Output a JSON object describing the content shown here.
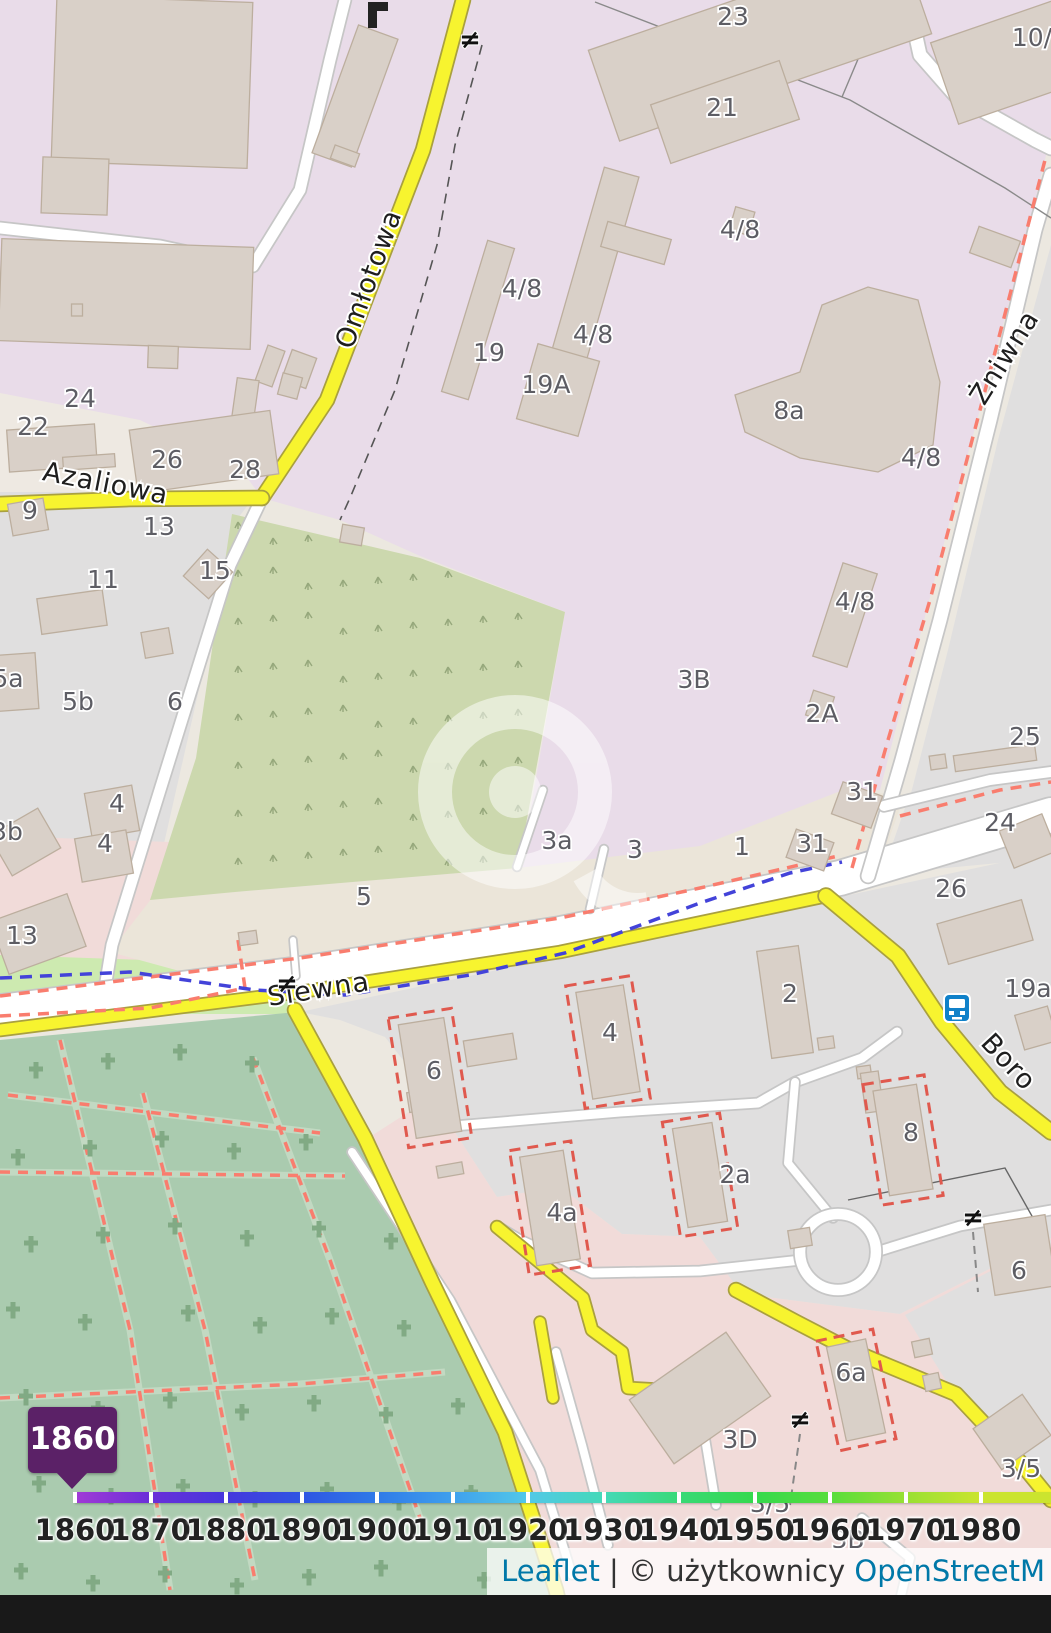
{
  "map": {
    "streets": [
      {
        "name": "Omłotowa",
        "x": 377,
        "y": 282,
        "rot": -70
      },
      {
        "name": "Azaliowa",
        "x": 104,
        "y": 492,
        "rot": 11
      },
      {
        "name": "Siewna",
        "x": 320,
        "y": 998,
        "rot": -9
      },
      {
        "name": "Żniwna",
        "x": 1012,
        "y": 362,
        "rot": -58
      },
      {
        "name": "Boro",
        "x": 1002,
        "y": 1068,
        "rot": 47
      }
    ],
    "house_numbers": [
      {
        "t": "23",
        "x": 733,
        "y": 25
      },
      {
        "t": "21",
        "x": 722,
        "y": 116
      },
      {
        "t": "10/",
        "x": 1032,
        "y": 46
      },
      {
        "t": "4/8",
        "x": 522,
        "y": 297
      },
      {
        "t": "4/8",
        "x": 593,
        "y": 343
      },
      {
        "t": "4/8",
        "x": 740,
        "y": 238
      },
      {
        "t": "4/8",
        "x": 921,
        "y": 466
      },
      {
        "t": "4/8",
        "x": 855,
        "y": 610
      },
      {
        "t": "19",
        "x": 489,
        "y": 361
      },
      {
        "t": "19A",
        "x": 546,
        "y": 393
      },
      {
        "t": "8a",
        "x": 789,
        "y": 419
      },
      {
        "t": "3B",
        "x": 694,
        "y": 688
      },
      {
        "t": "2A",
        "x": 822,
        "y": 722
      },
      {
        "t": "31",
        "x": 862,
        "y": 800
      },
      {
        "t": "31",
        "x": 812,
        "y": 852
      },
      {
        "t": "1",
        "x": 742,
        "y": 855
      },
      {
        "t": "3",
        "x": 635,
        "y": 858
      },
      {
        "t": "3a",
        "x": 557,
        "y": 849
      },
      {
        "t": "5",
        "x": 364,
        "y": 905
      },
      {
        "t": "24",
        "x": 80,
        "y": 407
      },
      {
        "t": "22",
        "x": 33,
        "y": 435
      },
      {
        "t": "26",
        "x": 167,
        "y": 468
      },
      {
        "t": "28",
        "x": 245,
        "y": 478
      },
      {
        "t": "9",
        "x": 30,
        "y": 519
      },
      {
        "t": "13",
        "x": 159,
        "y": 535
      },
      {
        "t": "15",
        "x": 215,
        "y": 579
      },
      {
        "t": "11",
        "x": 103,
        "y": 588
      },
      {
        "t": "5a",
        "x": 8,
        "y": 687
      },
      {
        "t": "5b",
        "x": 78,
        "y": 710
      },
      {
        "t": "6",
        "x": 175,
        "y": 710
      },
      {
        "t": "4",
        "x": 117,
        "y": 812
      },
      {
        "t": "4",
        "x": 105,
        "y": 852
      },
      {
        "t": "3b",
        "x": 7,
        "y": 840
      },
      {
        "t": "13",
        "x": 22,
        "y": 944
      },
      {
        "t": "25",
        "x": 1025,
        "y": 745
      },
      {
        "t": "24",
        "x": 1000,
        "y": 831
      },
      {
        "t": "26",
        "x": 951,
        "y": 897
      },
      {
        "t": "19a",
        "x": 1028,
        "y": 997
      },
      {
        "t": "2",
        "x": 790,
        "y": 1002
      },
      {
        "t": "6",
        "x": 434,
        "y": 1079
      },
      {
        "t": "4",
        "x": 610,
        "y": 1041
      },
      {
        "t": "4a",
        "x": 562,
        "y": 1221
      },
      {
        "t": "2a",
        "x": 735,
        "y": 1183
      },
      {
        "t": "8",
        "x": 911,
        "y": 1141
      },
      {
        "t": "6",
        "x": 1019,
        "y": 1279
      },
      {
        "t": "6a",
        "x": 851,
        "y": 1381
      },
      {
        "t": "3D",
        "x": 740,
        "y": 1448
      },
      {
        "t": "3/5",
        "x": 770,
        "y": 1512
      },
      {
        "t": "3/5",
        "x": 1021,
        "y": 1477
      },
      {
        "t": "3B",
        "x": 848,
        "y": 1548
      }
    ],
    "gate_symbol": "≠",
    "gates": [
      {
        "x": 470,
        "y": 48
      },
      {
        "x": 287,
        "y": 992
      },
      {
        "x": 973,
        "y": 1226
      },
      {
        "x": 800,
        "y": 1428
      }
    ],
    "bus_stop": {
      "x": 957,
      "y": 1008
    }
  },
  "timeline": {
    "years": [
      "1860",
      "1870",
      "1880",
      "1890",
      "1900",
      "1910",
      "1920",
      "1930",
      "1940",
      "1950",
      "1960",
      "1970",
      "1980"
    ],
    "selected_year": "1860",
    "start_x": 75,
    "step": 75.5,
    "gradient": [
      "#a13ad6",
      "#6a2fd8",
      "#4537dd",
      "#2f55e3",
      "#2f7ae8",
      "#3fa0ed",
      "#52c8e8",
      "#45d9b8",
      "#38d977",
      "#35d94d",
      "#58dd3c",
      "#98e033",
      "#cbe42f"
    ],
    "badge_color": "#5b2167"
  },
  "attribution": {
    "leaflet": "Leaflet",
    "separator": "|",
    "copyright": "© użytkownicy",
    "osm_link": "OpenStreetM"
  },
  "colors": {
    "road_yellow": "#f7f42f",
    "industrial_area": "#e9dce9",
    "residential_area": "#e0dfdf",
    "commercial_area": "#f1dbd9",
    "cemetery_area": "#aacbaf",
    "scrub_area": "#ccd8ae",
    "grass_area": "#cdeab0",
    "footpath_dash": "#f97d6e",
    "ditch_dash": "#4343d9",
    "bus_icon_blue": "#1081c9",
    "attribution_link": "#0078a8",
    "badge_purple": "#5b2167"
  }
}
